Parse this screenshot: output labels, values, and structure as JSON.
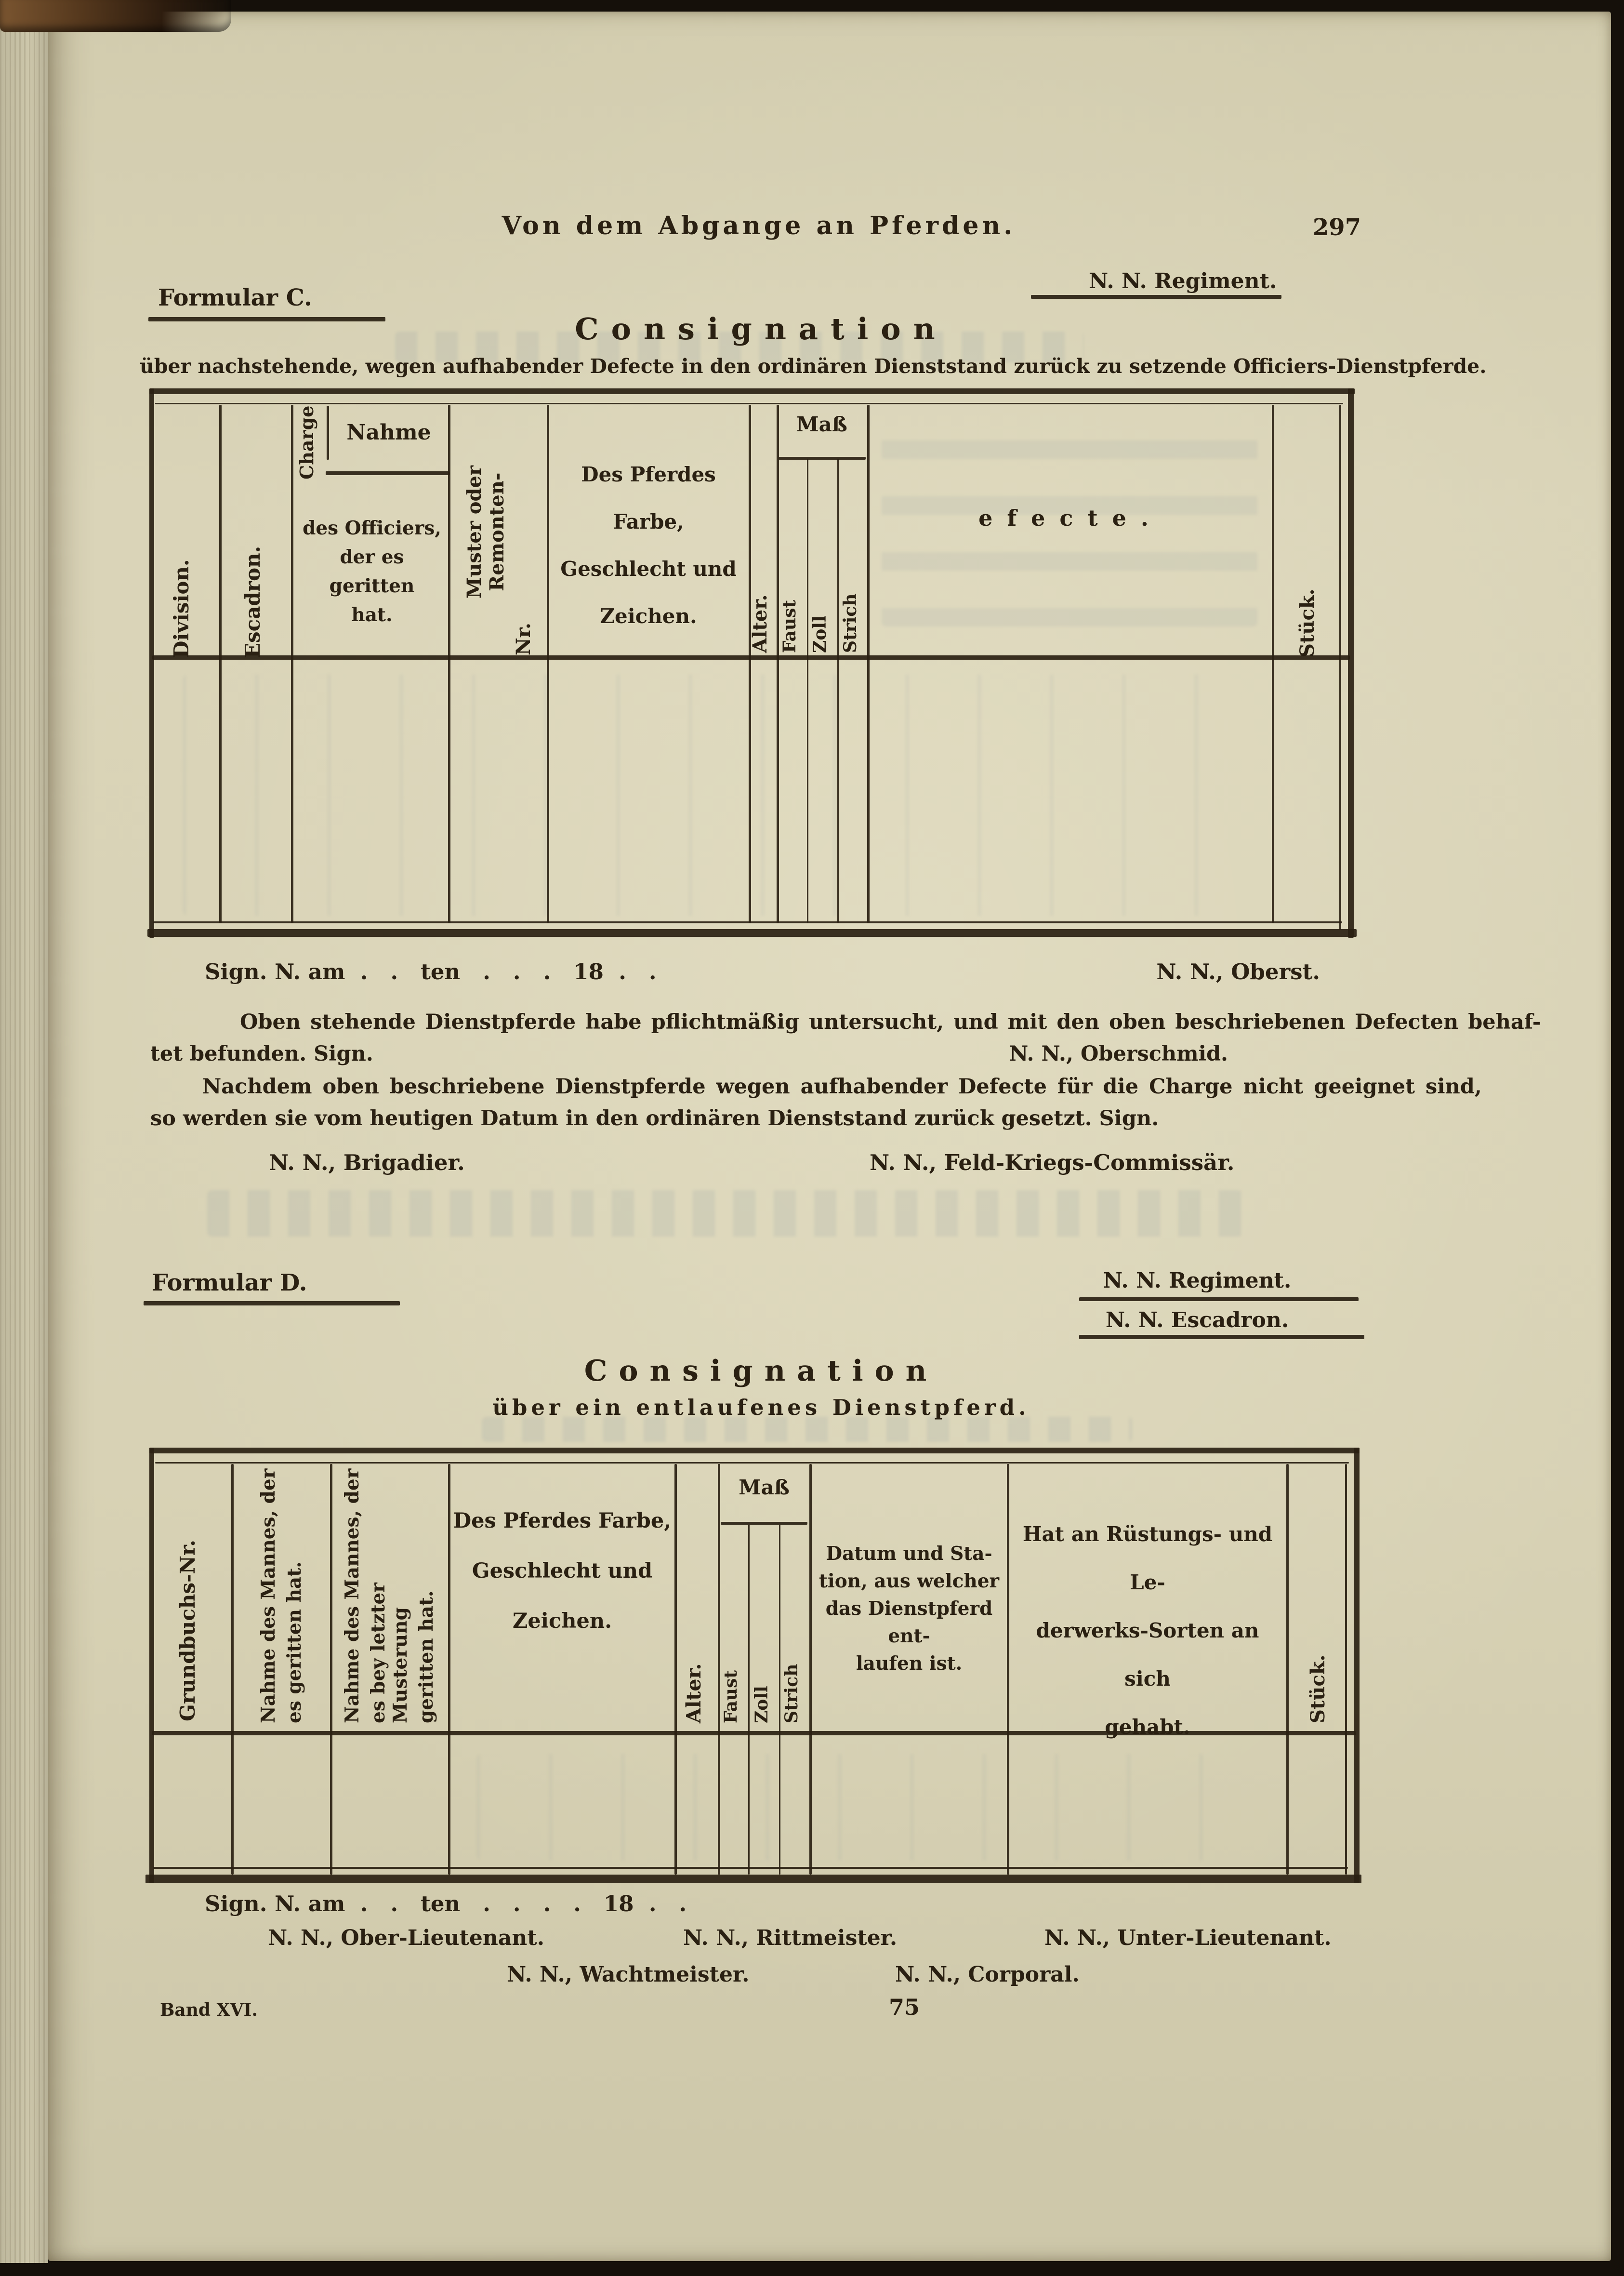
{
  "colors": {
    "paper": "#d6d0b3",
    "ink": "#2a2012",
    "table_rule": "#2a2112",
    "surround": "#15100a",
    "bleedthrough": "#7a8a9a"
  },
  "page": {
    "running_header": "Von dem Abgange an Pferden.",
    "page_number": "297",
    "footer_volume": "Band XVI.",
    "footer_sheet": "75"
  },
  "formular_c": {
    "label": "Formular C.",
    "regiment": "N. N. Regiment.",
    "title": "Consignation",
    "subtitle": "über nachstehende, wegen aufhabender Defecte in den ordinären Dienststand zurück zu setzende Officiers-Dienstpferde.",
    "table": {
      "division": "Division.",
      "escadron": "Escadron.",
      "charge": "Charge",
      "nahme": "Nahme",
      "nahme_sub": [
        "des Officiers,",
        "der es geritten",
        "hat."
      ],
      "muster_main": "Muster oder Remonten-",
      "muster_nr": "Nr.",
      "farbe": [
        "Des Pferdes Farbe,",
        "Geschlecht und",
        "Zeichen."
      ],
      "alter": "Alter.",
      "mass": "Maß",
      "faust": "Faust",
      "zoll": "Zoll",
      "strich": "Strich",
      "defecte": "efecte.",
      "stueck": "Stück."
    },
    "sign_line": "Sign. N. am  .   .   ten   .   .   .   18  .   .",
    "sign_name": "N. N., Oberst.",
    "para1": [
      "Oben stehende Dienstpferde habe pflichtmäßig untersucht, und mit den oben beschriebenen Defecten behaf-",
      "tet befunden.   Sign."
    ],
    "para1_name": "N. N., Oberschmid.",
    "para2": [
      "Nachdem oben beschriebene Dienstpferde wegen aufhabender Defecte für die Charge nicht geeignet sind,",
      "so werden sie vom heutigen Datum in den ordinären Dienststand zurück gesetzt.   Sign."
    ],
    "sig_brigadier": "N. N., Brigadier.",
    "sig_commissar": "N. N., Feld-Kriegs-Commissär."
  },
  "formular_d": {
    "label": "Formular D.",
    "regiment": "N. N. Regiment.",
    "escadron": "N. N. Escadron.",
    "title": "Consignation",
    "subtitle": "über ein entlaufenes Dienstpferd.",
    "table": {
      "grundbuch": "Grundbuchs-Nr.",
      "mann1": [
        "Nahme des Mannes, der",
        "es geritten hat."
      ],
      "mann2": [
        "Nahme des Mannes, der",
        "es bey letzter Musterung",
        "geritten hat."
      ],
      "farbe": [
        "Des Pferdes Farbe,",
        "Geschlecht und",
        "Zeichen."
      ],
      "alter": "Alter.",
      "mass": "Maß",
      "faust": "Faust",
      "zoll": "Zoll",
      "strich": "Strich",
      "datum": [
        "Datum und Sta-",
        "tion, aus welcher",
        "das Dienstpferd ent-",
        "laufen ist."
      ],
      "ruestung": [
        "Hat an Rüstungs- und Le-",
        "derwerks-Sorten an sich",
        "gehabt."
      ],
      "stueck": "Stück."
    },
    "sign_line": "Sign. N. am  .   .   ten   .   .   .   .   18  .   .",
    "sig_row1": [
      "N. N., Ober-Lieutenant.",
      "N. N., Rittmeister.",
      "N. N., Unter-Lieutenant."
    ],
    "sig_row2": [
      "N. N., Wachtmeister.",
      "N. N., Corporal."
    ]
  }
}
